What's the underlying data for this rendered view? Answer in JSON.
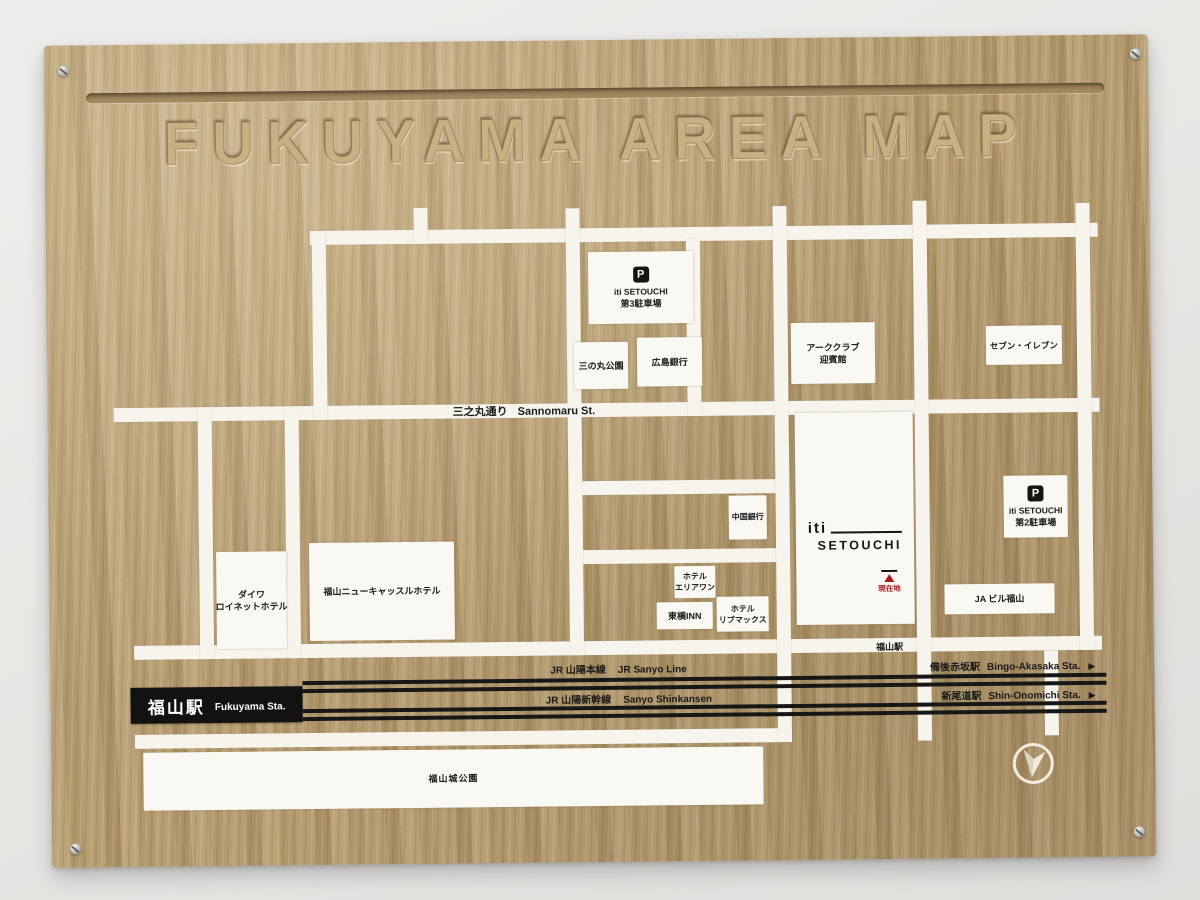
{
  "board": {
    "title": "FUKUYAMA AREA MAP",
    "wood_color": "#b49b6f",
    "road_color": "#f7f4ed",
    "ink_color": "#1a1a1a",
    "accent_red": "#b0161f"
  },
  "map": {
    "parking_glyph": "P",
    "dest_arrow": "▶",
    "street": {
      "jp": "三之丸通り",
      "en": "Sannomaru St."
    },
    "station_on_road": "福山駅",
    "station_box": {
      "jp": "福山駅",
      "en": "Fukuyama Sta."
    },
    "iti_building": {
      "logo_word": "iti",
      "logo_sub": "SETOUCHI"
    },
    "current_location": {
      "label": "現在地"
    },
    "railways": [
      {
        "id": "jr-sanyo-line",
        "label_jp": "JR 山陽本線",
        "label_en": "JR Sanyo Line",
        "dest_jp": "備後赤坂駅",
        "dest_en": "Bingo-Akasaka Sta."
      },
      {
        "id": "sanyo-shinkansen",
        "label_jp": "JR 山陽新幹線",
        "label_en": "Sanyo Shinkansen",
        "dest_jp": "新尾道駅",
        "dest_en": "Shin-Onomichi Sta."
      }
    ],
    "roads_h": [
      {
        "id": "top-street",
        "x": 264,
        "y": 188,
        "w": 788
      },
      {
        "id": "sannomaru-street",
        "x": 66,
        "y": 363,
        "w": 986
      },
      {
        "id": "mid-street-upper",
        "x": 522,
        "y": 441,
        "w": 218
      },
      {
        "id": "mid-street-lower",
        "x": 522,
        "y": 510,
        "w": 218
      },
      {
        "id": "station-street",
        "x": 84,
        "y": 601,
        "w": 968
      },
      {
        "id": "south-street",
        "x": 84,
        "y": 690,
        "w": 645
      }
    ],
    "roads_v": [
      {
        "id": "west-cross-1",
        "x": 150,
        "y": 363,
        "h": 252
      },
      {
        "id": "west-cross-2",
        "x": 237,
        "y": 363,
        "h": 252
      },
      {
        "id": "northwest-cross",
        "x": 266,
        "y": 188,
        "h": 189
      },
      {
        "id": "north-stub",
        "x": 368,
        "y": 166,
        "h": 36
      },
      {
        "id": "center-cross",
        "x": 520,
        "y": 168,
        "h": 447
      },
      {
        "id": "bank-cross",
        "x": 640,
        "y": 200,
        "h": 177
      },
      {
        "id": "iti-west-cross",
        "x": 727,
        "y": 168,
        "h": 536
      },
      {
        "id": "iti-east-cross",
        "x": 867,
        "y": 164,
        "h": 540
      },
      {
        "id": "east-cross",
        "x": 1030,
        "y": 168,
        "h": 447
      },
      {
        "id": "east-rail-cross",
        "x": 994,
        "y": 615,
        "h": 85
      }
    ],
    "places": [
      {
        "id": "iti-setouchi-parking-3",
        "icon": "parking",
        "lines": [
          "iti SETOUCHI",
          "第3駐車場"
        ],
        "x": 542,
        "y": 212,
        "w": 105,
        "h": 72
      },
      {
        "id": "sannomaru-park",
        "lines": [
          "三の丸公園"
        ],
        "x": 527,
        "y": 302,
        "w": 54,
        "h": 47
      },
      {
        "id": "hiroshima-bank",
        "lines": [
          "広島銀行"
        ],
        "x": 590,
        "y": 298,
        "w": 65,
        "h": 49
      },
      {
        "id": "ark-club-geihinkan",
        "lines": [
          "アーククラブ",
          "迎賓館"
        ],
        "x": 744,
        "y": 285,
        "w": 84,
        "h": 61
      },
      {
        "id": "seven-eleven",
        "lines": [
          "セブン・イレブン"
        ],
        "x": 939,
        "y": 290,
        "w": 76,
        "h": 39
      },
      {
        "id": "chugoku-bank",
        "lines": [
          "中国銀行"
        ],
        "x": 680,
        "y": 457,
        "w": 38,
        "h": 44
      },
      {
        "id": "iti-setouchi-parking-2",
        "icon": "parking",
        "lines": [
          "iti SETOUCHI",
          "第2駐車場"
        ],
        "x": 955,
        "y": 440,
        "w": 64,
        "h": 62
      },
      {
        "id": "daiwa-roynet-hotel",
        "lines": [
          "ダイワ",
          "ロイネットホテル"
        ],
        "x": 167,
        "y": 508,
        "w": 70,
        "h": 97
      },
      {
        "id": "fukuyama-new-castle-hotel",
        "lines": [
          "福山ニューキャッスルホテル"
        ],
        "x": 260,
        "y": 500,
        "w": 145,
        "h": 98
      },
      {
        "id": "hotel-area-one",
        "lines": [
          "ホテル",
          "エリアワン"
        ],
        "x": 625,
        "y": 527,
        "w": 41,
        "h": 32
      },
      {
        "id": "toyoko-inn",
        "lines": [
          "東横INN"
        ],
        "x": 607,
        "y": 563,
        "w": 56,
        "h": 27
      },
      {
        "id": "hotel-livemax",
        "lines": [
          "ホテル",
          "リブマックス"
        ],
        "x": 667,
        "y": 558,
        "w": 52,
        "h": 35
      },
      {
        "id": "ja-building-fukuyama",
        "lines": [
          "JA ビル福山"
        ],
        "x": 895,
        "y": 548,
        "w": 110,
        "h": 30
      },
      {
        "id": "fukuyama-castle-park",
        "lines": [
          "福山城公園"
        ],
        "x": 92,
        "y": 708,
        "w": 620,
        "h": 58
      }
    ]
  }
}
